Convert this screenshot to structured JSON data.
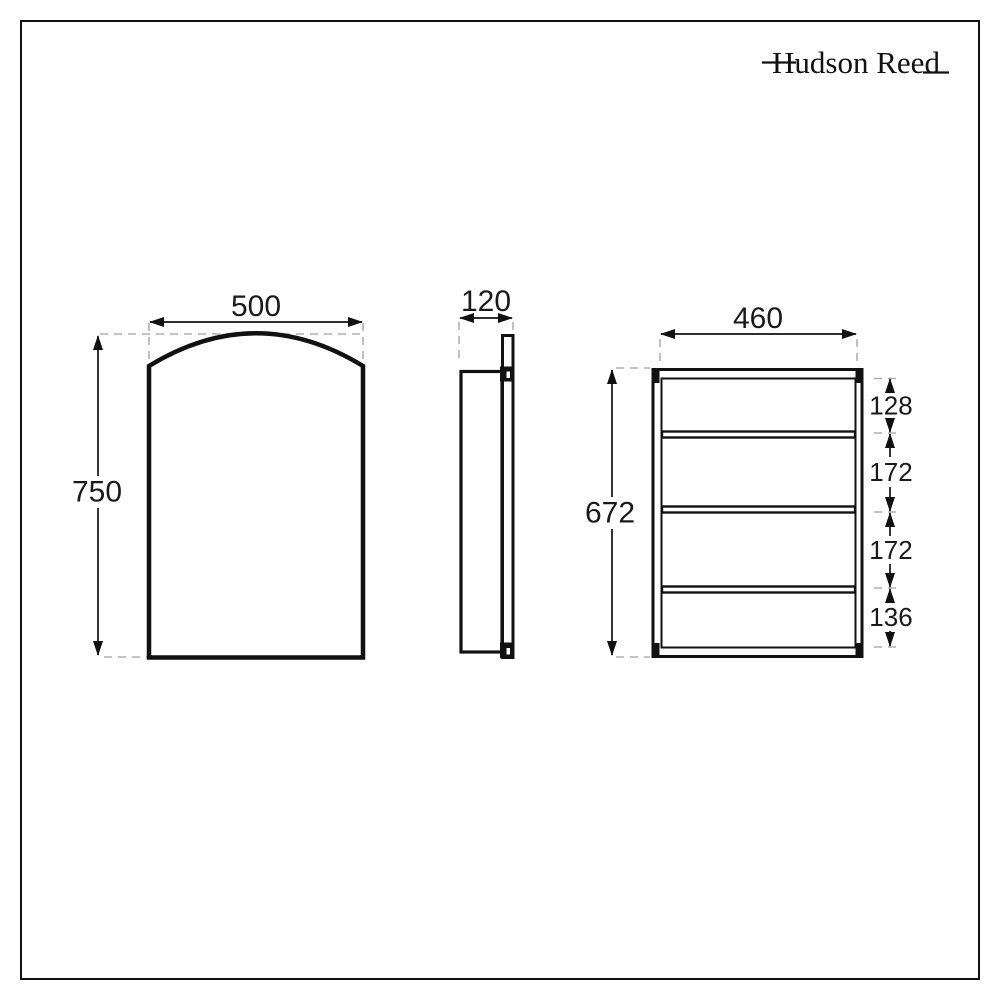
{
  "brand": {
    "name": "Hudson Reed"
  },
  "views": {
    "front": {
      "name": "front view (arched mirror door)",
      "width_label": "500",
      "height_label": "750"
    },
    "side": {
      "name": "side profile view",
      "depth_label": "120"
    },
    "internal": {
      "name": "internal shelf view",
      "width_label": "460",
      "height_label": "672",
      "compartments": [
        {
          "label": "128"
        },
        {
          "label": "172"
        },
        {
          "label": "172"
        },
        {
          "label": "136"
        }
      ]
    }
  },
  "colors": {
    "line": "#111111",
    "dashed": "#b0b0b0",
    "background": "#ffffff"
  }
}
